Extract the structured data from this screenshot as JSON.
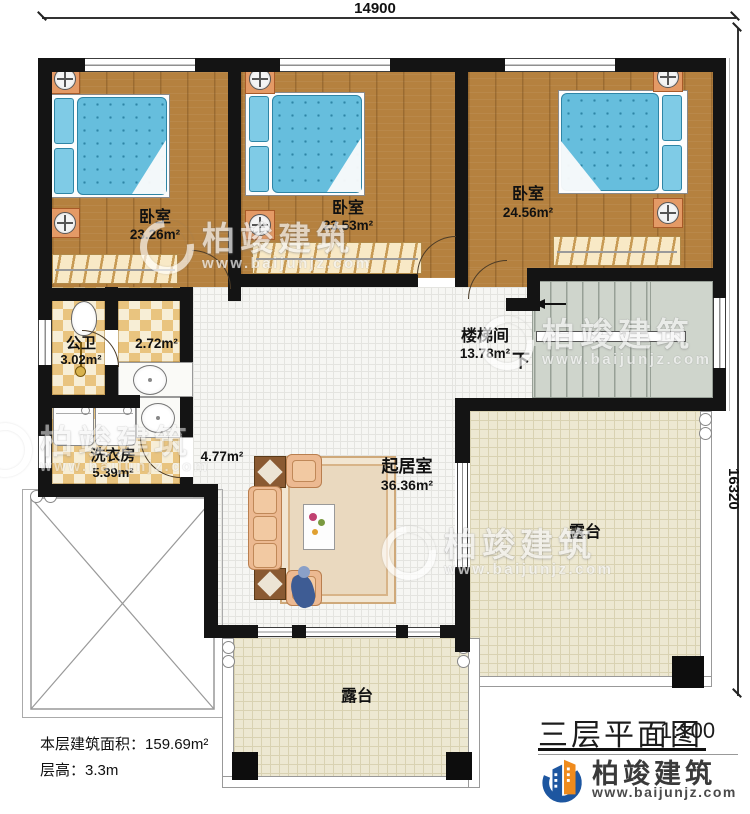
{
  "dimensions": {
    "top": "14900",
    "right": "16320"
  },
  "rooms": {
    "bedroom1": {
      "label": "卧室",
      "area": "23.26m²"
    },
    "bedroom2": {
      "label": "卧室",
      "area": "23.53m²"
    },
    "bedroom3": {
      "label": "卧室",
      "area": "24.56m²"
    },
    "bathroom": {
      "label": "公卫",
      "area": "3.02m²"
    },
    "vanity": {
      "area": "2.72m²"
    },
    "laundry": {
      "label": "洗衣房",
      "area": "5.39m²"
    },
    "hallway": {
      "area": "4.77m²"
    },
    "stairwell": {
      "label": "楼梯间",
      "area": "13.78m²",
      "direction_label": "下"
    },
    "living": {
      "label": "起居室",
      "area": "36.36m²"
    },
    "terrace_right": {
      "label": "露台"
    },
    "terrace_bottom": {
      "label": "露台"
    }
  },
  "annotations": {
    "floor_area_label": "本层建筑面积：",
    "floor_area_value": "159.69m²",
    "floor_height_label": "层高：",
    "floor_height_value": "3.3m"
  },
  "title_block": {
    "title": "三层平面图",
    "scale": "1:100",
    "brand": "柏竣建筑",
    "website": "www.baijunjz.com"
  },
  "watermark": {
    "brand": "柏竣建筑",
    "website": "www.baijunjz.com"
  },
  "colors": {
    "wall": "#141414",
    "wood_floor": "#b5813f",
    "bed_blue": "#66bedd",
    "tile_checker": "#e9c47f",
    "terrace_tile": "#ede8d2",
    "stair_gray": "#cfd5cc",
    "brand_blue": "#1d56a0",
    "brand_orange": "#ef8b1d"
  }
}
